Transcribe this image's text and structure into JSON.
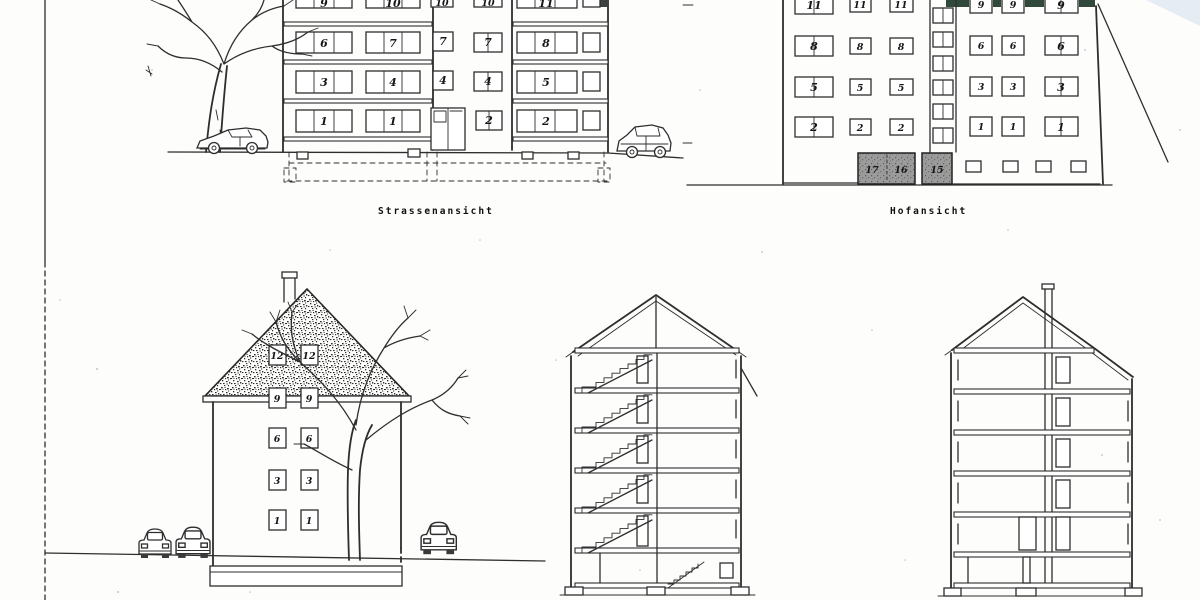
{
  "captions": {
    "street": "Strassenansicht",
    "court": "Hofansicht"
  },
  "street": {
    "rows": [
      [
        "9",
        "10",
        "10",
        "10",
        "11"
      ],
      [
        "6",
        "7",
        "7",
        "7",
        "8"
      ],
      [
        "3",
        "4",
        "4",
        "4",
        "5"
      ],
      [
        "1",
        "1",
        "",
        "2",
        "2"
      ]
    ]
  },
  "hof": {
    "left_rows": [
      [
        "11",
        "11",
        "11"
      ],
      [
        "8",
        "8",
        "8"
      ],
      [
        "5",
        "5",
        "5"
      ],
      [
        "2",
        "2",
        "2"
      ]
    ],
    "right_rows": [
      [
        "9",
        "9",
        "9"
      ],
      [
        "6",
        "6",
        "6"
      ],
      [
        "3",
        "3",
        "3"
      ],
      [
        "1",
        "1",
        "1"
      ]
    ],
    "garage": [
      "17",
      "16",
      "15"
    ]
  },
  "gable": {
    "rows": [
      [
        "12",
        "12"
      ],
      [
        "9",
        "9"
      ],
      [
        "6",
        "6"
      ],
      [
        "3",
        "3"
      ],
      [
        "1",
        "1"
      ]
    ]
  }
}
